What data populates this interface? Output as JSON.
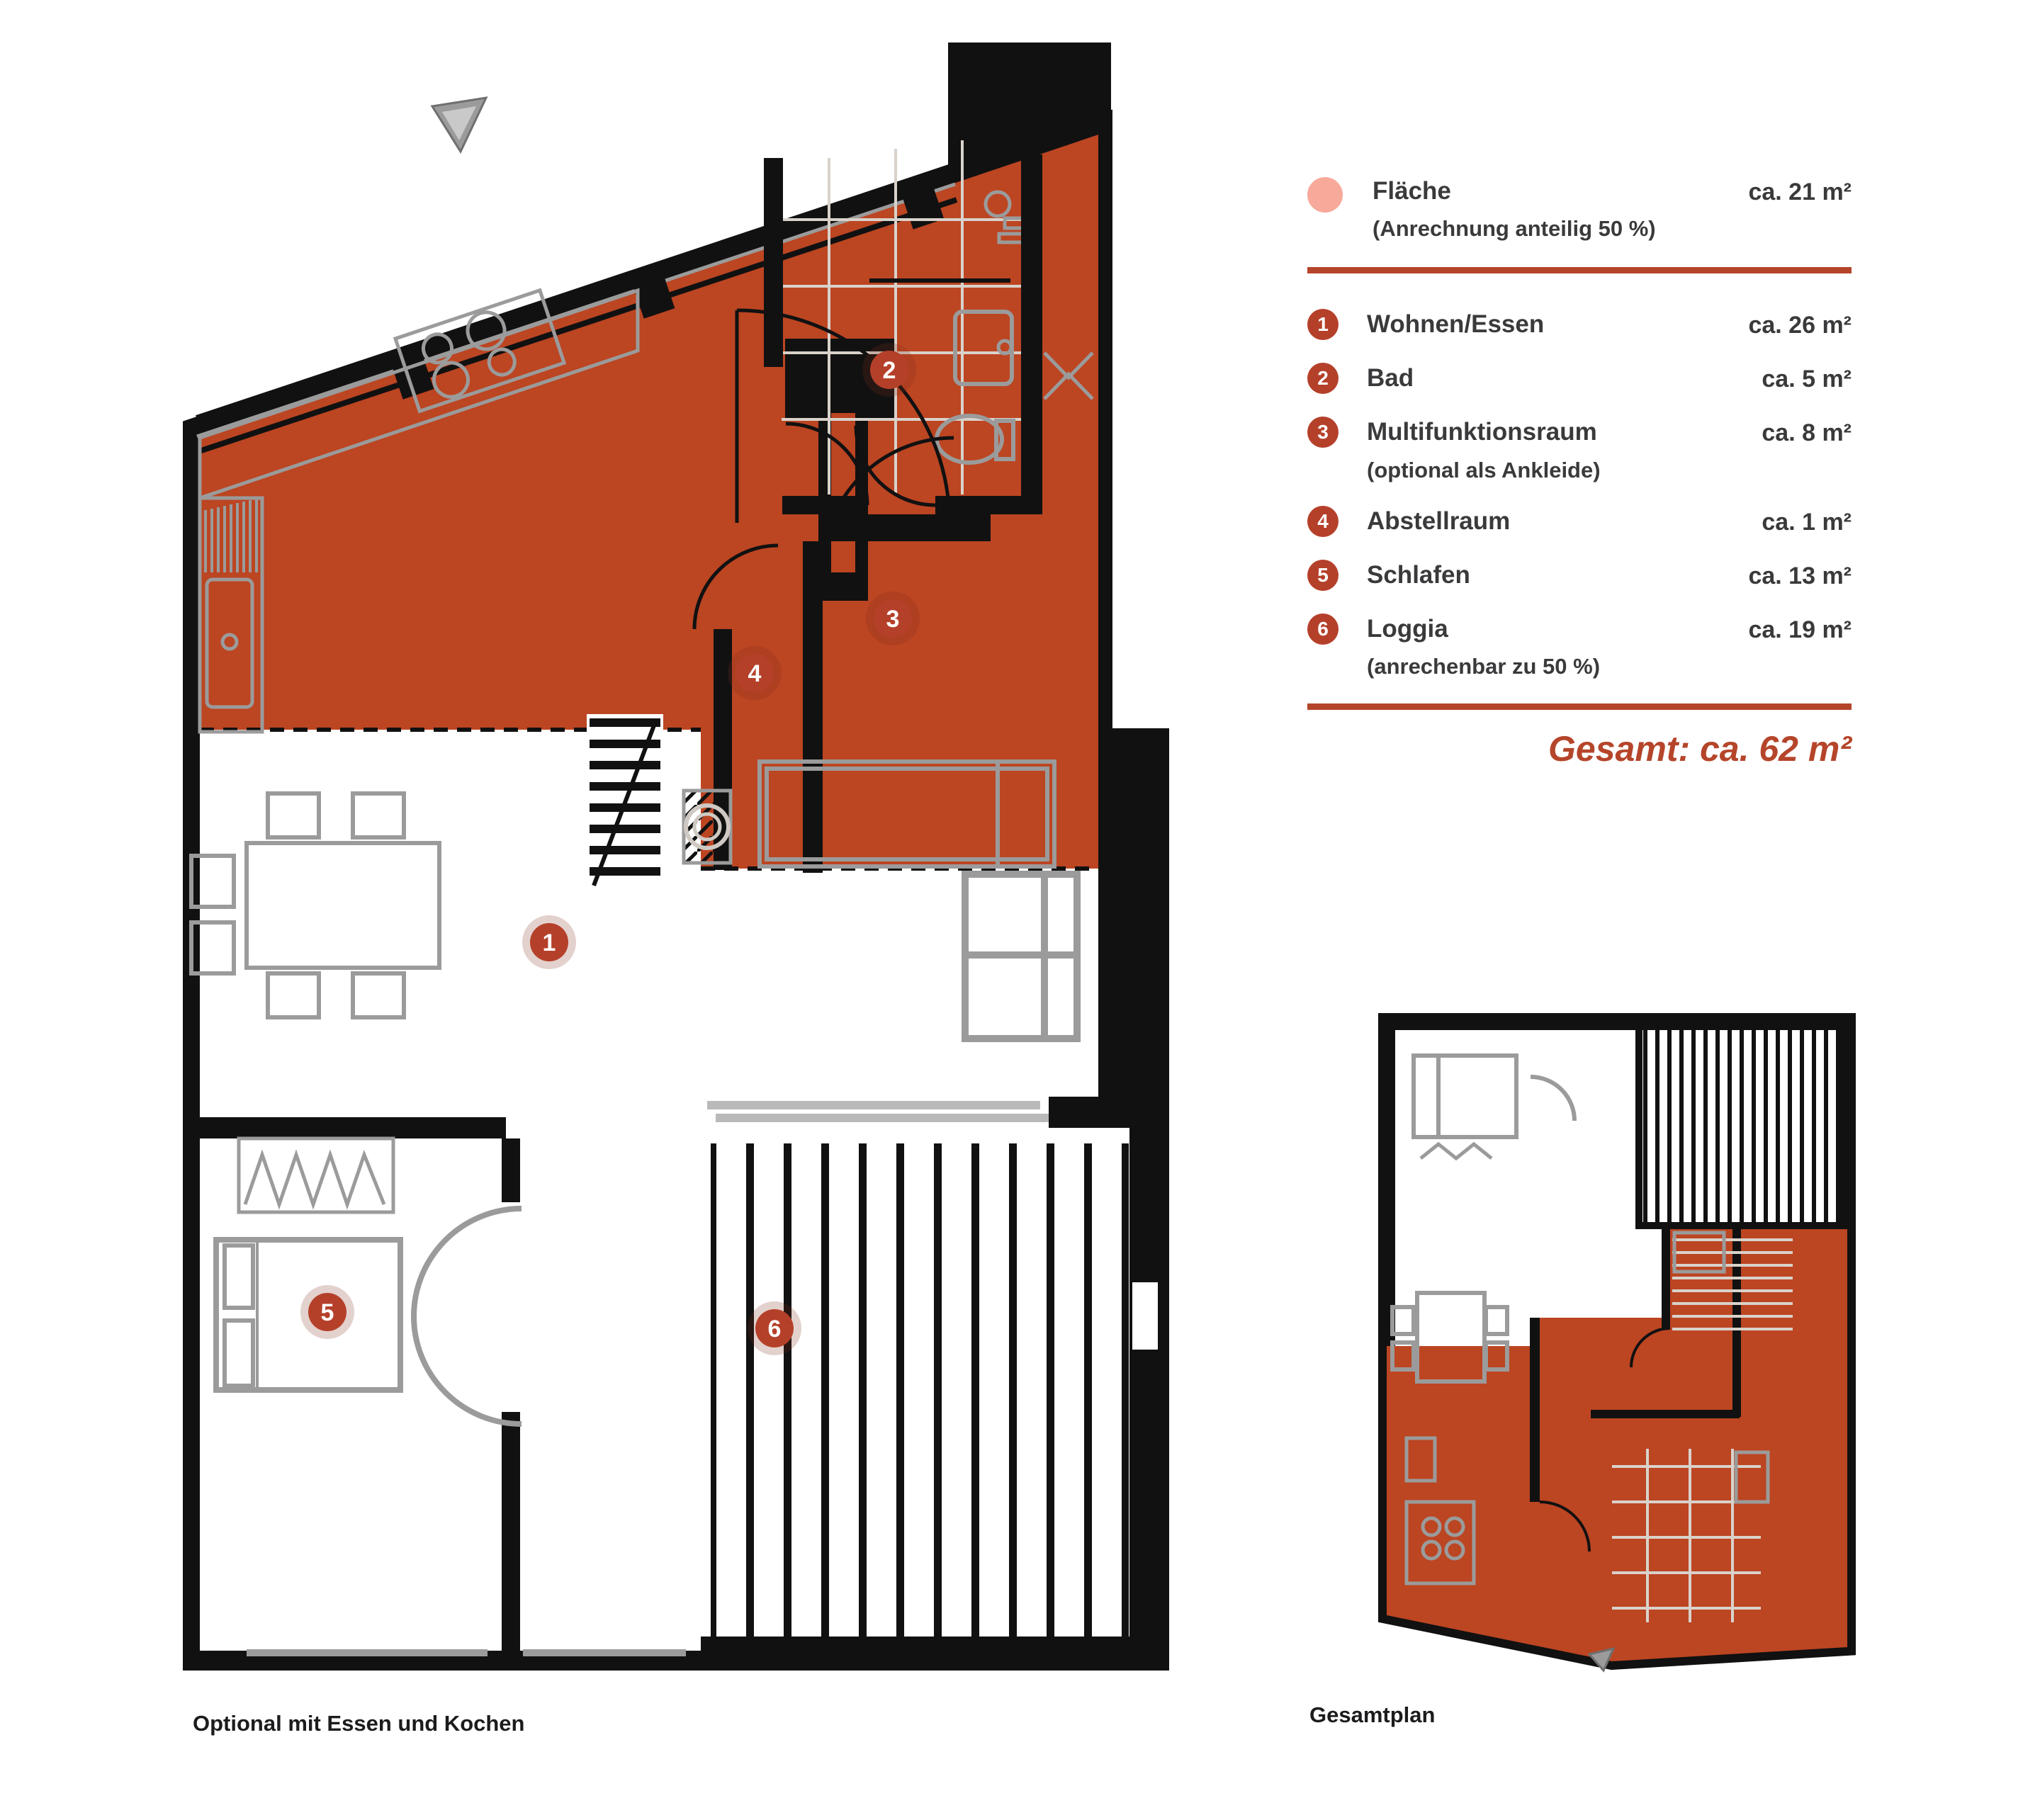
{
  "legend": {
    "highlight": {
      "swatch_icon": "pink-circle-swatch",
      "label": "Fläche",
      "note": "(Anrechnung anteilig 50 %)",
      "area": "ca. 21 m²"
    },
    "rooms": [
      {
        "number": "1",
        "label": "Wohnen/Essen",
        "area": "ca. 26 m²"
      },
      {
        "number": "2",
        "label": "Bad",
        "area": "ca. 5 m²"
      },
      {
        "number": "3",
        "label": "Multifunktionsraum",
        "note": "(optional als Ankleide)",
        "area": "ca. 8 m²"
      },
      {
        "number": "4",
        "label": "Abstellraum",
        "area": "ca. 1 m²"
      },
      {
        "number": "5",
        "label": "Schlafen",
        "area": "ca. 13 m²"
      },
      {
        "number": "6",
        "label": "Loggia",
        "note": "(anrechenbar zu 50 %)",
        "area": "ca. 19 m²"
      }
    ],
    "total": "Gesamt: ca. 62 m²"
  },
  "plans": {
    "main": {
      "caption": "Optional mit Essen und Kochen"
    },
    "key": {
      "caption": "Gesamtplan"
    }
  },
  "colors": {
    "accent": "#b5452a",
    "plan_fill": "#bc4522",
    "swatch_pink": "#f7a99a",
    "text_dark": "#3a3a3c",
    "wall_black": "#111111",
    "furniture_gray": "#9b9b9b",
    "tile_line": "#d9d2cb"
  }
}
